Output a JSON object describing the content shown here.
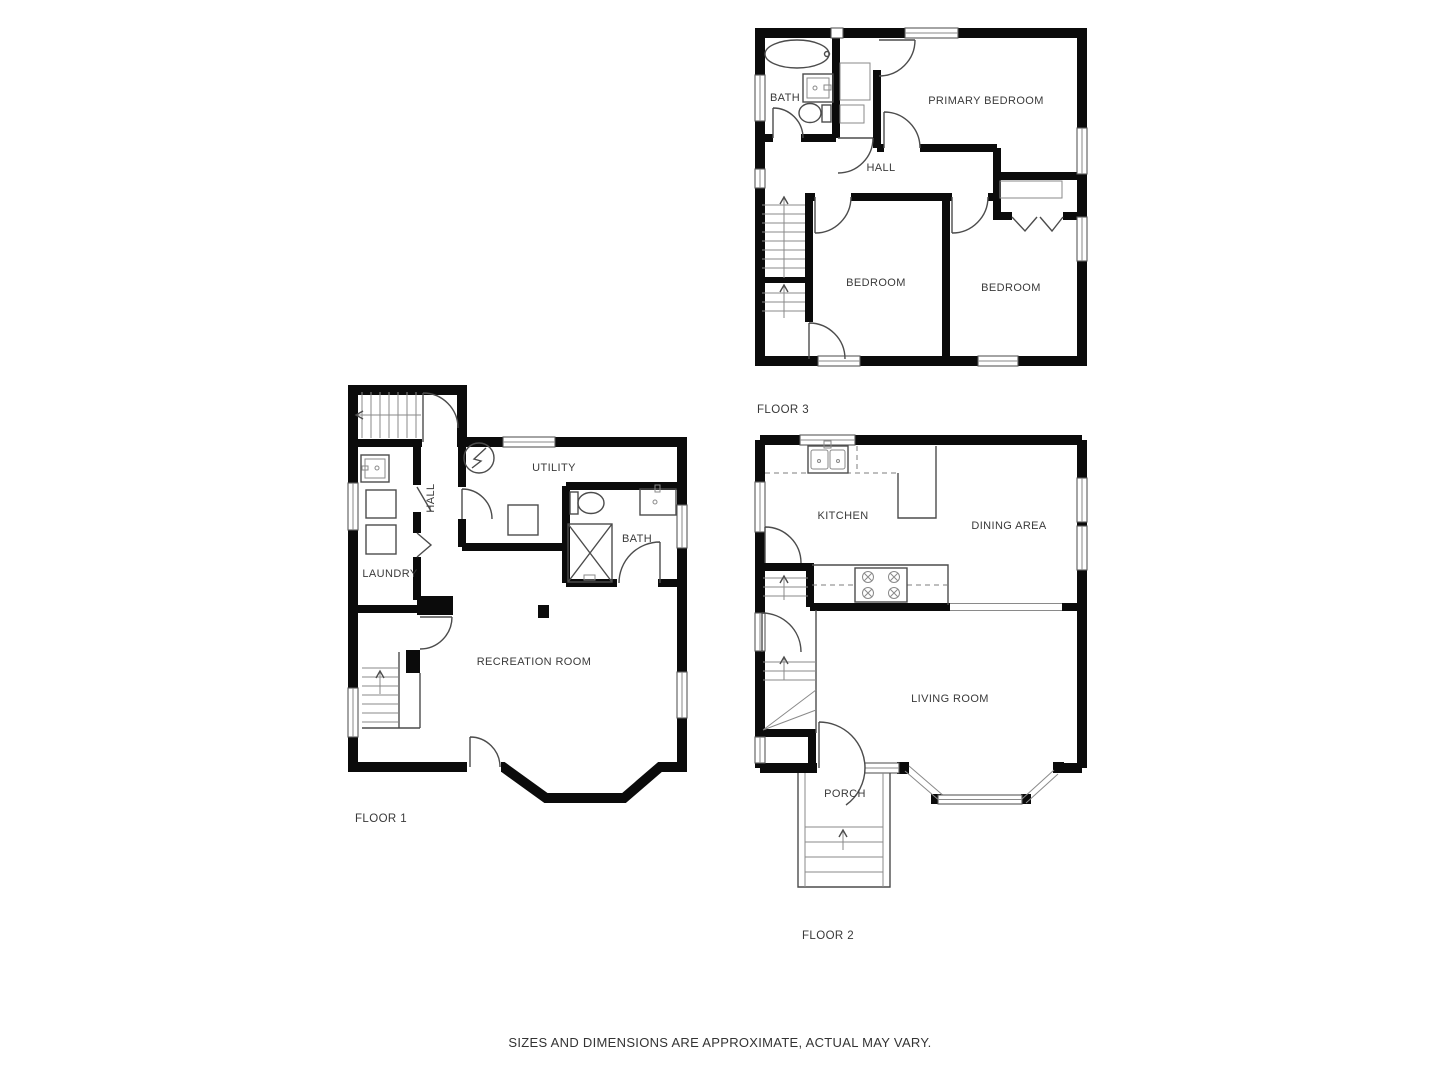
{
  "disclaimer": "SIZES AND DIMENSIONS ARE APPROXIMATE, ACTUAL MAY VARY.",
  "colors": {
    "wall": "#0b0b0b",
    "fixture_line": "#4c4c4c",
    "label_text": "#3a3a3a",
    "background": "#ffffff"
  },
  "floors": {
    "floor1": {
      "label": "FLOOR 1",
      "rooms": {
        "utility": "UTILITY",
        "hall": "HALL",
        "laundry": "LAUNDRY",
        "bath": "BATH",
        "recreation": "RECREATION ROOM"
      },
      "fixtures": [
        "staircase-up",
        "basement-stairs",
        "laundry-sink",
        "washer",
        "dryer",
        "water-heater",
        "furnace",
        "toilet",
        "bathroom-sink",
        "shower",
        "exterior-door",
        "bay-wall"
      ]
    },
    "floor2": {
      "label": "FLOOR 2",
      "rooms": {
        "kitchen": "KITCHEN",
        "dining": "DINING AREA",
        "living": "LIVING ROOM",
        "porch": "PORCH"
      },
      "fixtures": [
        "kitchen-sink",
        "countertop",
        "stove",
        "staircase",
        "winder-stairs",
        "front-door",
        "porch-steps",
        "bay-window"
      ]
    },
    "floor3": {
      "label": "FLOOR 3",
      "rooms": {
        "bath": "BATH",
        "primary": "PRIMARY BEDROOM",
        "hall": "HALL",
        "bedroom_left": "BEDROOM",
        "bedroom_right": "BEDROOM"
      },
      "fixtures": [
        "bathtub",
        "bathroom-sink",
        "toilet",
        "linen-closet",
        "staircase",
        "bifold-closet"
      ]
    }
  }
}
